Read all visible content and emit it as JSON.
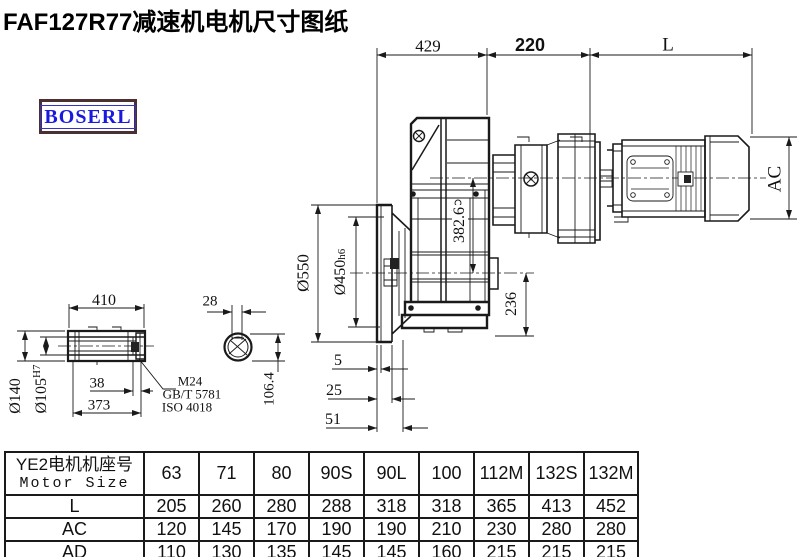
{
  "title": "FAF127R77减速机电机尺寸图纸",
  "logo": {
    "text": "BOSERL"
  },
  "colors": {
    "line": "#1a1a1a",
    "logo_border": "#4a3030",
    "logo_text": "#1a1adf"
  },
  "dims": {
    "top_429": "429",
    "top_220": "220",
    "top_L": "L",
    "ac": "AC",
    "axis_382": "382.6",
    "foot_236": "236",
    "flange_od": "Ø550",
    "flange_spigot": "Ø450",
    "flange_spigot_tol": "h6",
    "shaft_len_410": "410",
    "shaft_od_140": "Ø140",
    "bore_105": "Ø105",
    "bore_105_tol": "H7",
    "end_38": "38",
    "len_373": "373",
    "key_28": "28",
    "key_depth_106": "106.4",
    "face_5": "5",
    "face_25": "25",
    "face_51": "51",
    "leader_m24": "M24",
    "leader_gbt": "GB/T 5781",
    "leader_iso": "ISO 4018"
  },
  "table": {
    "header_cn": "YE2电机机座号",
    "header_en": "Motor Size",
    "columns": [
      "63",
      "71",
      "80",
      "90S",
      "90L",
      "100",
      "112M",
      "132S",
      "132M"
    ],
    "rows": [
      {
        "label": "L",
        "values": [
          "205",
          "260",
          "280",
          "288",
          "318",
          "318",
          "365",
          "413",
          "452"
        ]
      },
      {
        "label": "AC",
        "values": [
          "120",
          "145",
          "170",
          "190",
          "190",
          "210",
          "230",
          "280",
          "280"
        ]
      },
      {
        "label": "AD",
        "values": [
          "110",
          "130",
          "135",
          "145",
          "145",
          "160",
          "215",
          "215",
          "215"
        ]
      }
    ]
  }
}
